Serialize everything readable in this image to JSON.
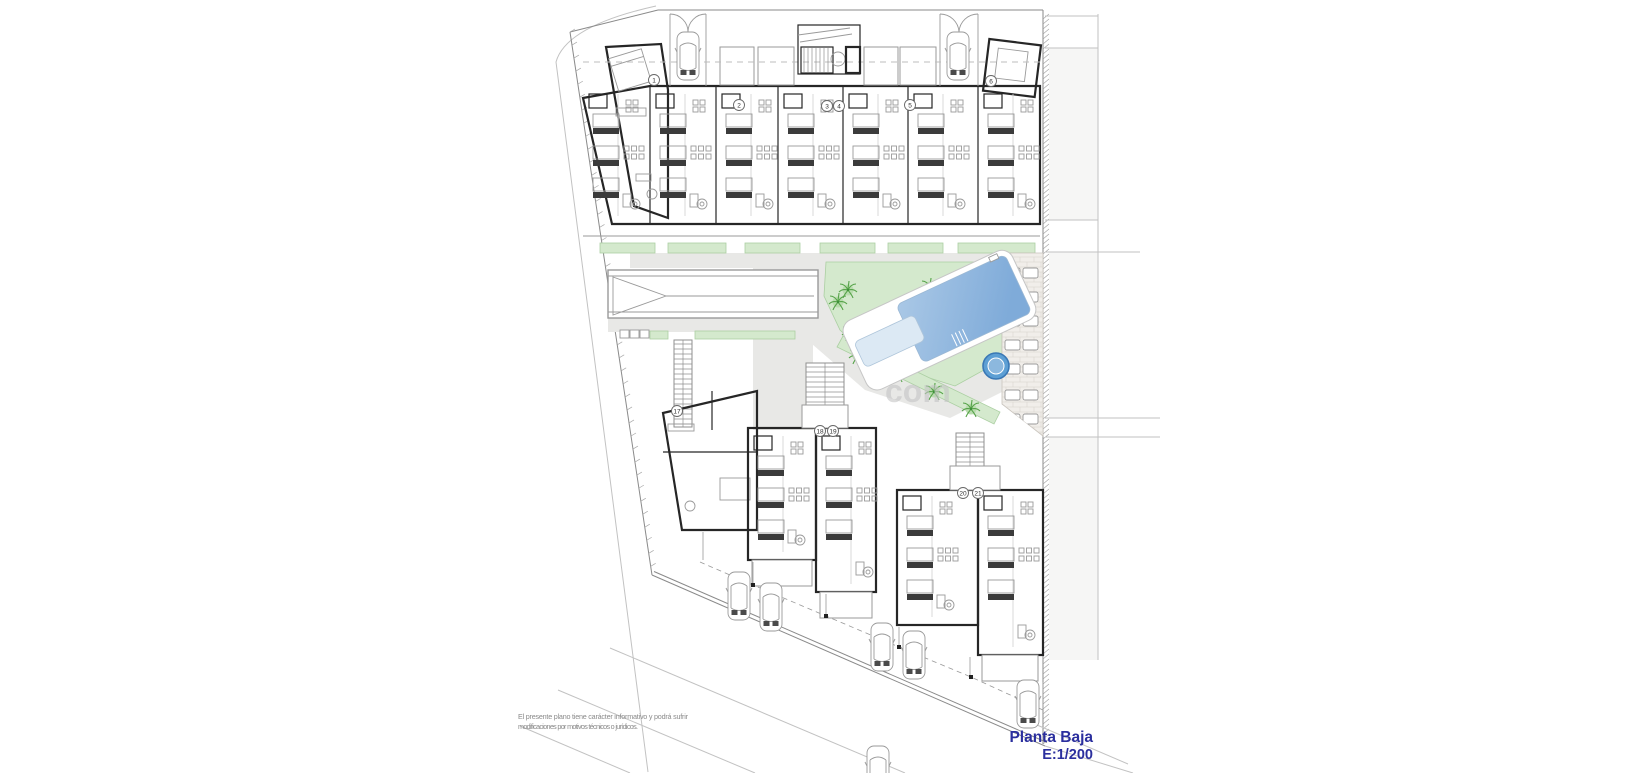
{
  "title": {
    "name": "Planta Baja",
    "scale": "E:1/200"
  },
  "disclaimer": {
    "line1": "El presente plano tiene carácter informativo y podrá sufrir",
    "line2": "modificaciones por motivos técnicos o jurídicos."
  },
  "watermark": "com",
  "unit_badges": [
    "1",
    "2",
    "3",
    "4",
    "5",
    "6",
    "17",
    "18",
    "19",
    "20",
    "21"
  ],
  "colors": {
    "wall": "#262626",
    "furniture": "#9a9a9a",
    "boundary": "#8a8a8a",
    "road": "#c2c2c2",
    "path": "#e8e8e6",
    "garden": "#d4e9cd",
    "garden_edge": "#abcfa2",
    "palm": "#55a348",
    "palm_light": "#b9dcae",
    "pool_deck": "#ffffff",
    "pool_deck_edge": "#c6c6c6",
    "pool_water": "#8fb8e0",
    "pool_water_deep": "#6ea3d6",
    "pool_water_light": "#dce9f4",
    "spa": "#5d9fd4",
    "spa_ring": "#3a78b5",
    "spa_inner": "#8cb8de",
    "brick": "#f1eeea",
    "brick_line": "#d6d1ca",
    "margin_fill": "#f6f6f5",
    "title": "#2b2f9e",
    "disclaimer_text": "#8a8a8a",
    "watermark": "#c5c5c5"
  }
}
